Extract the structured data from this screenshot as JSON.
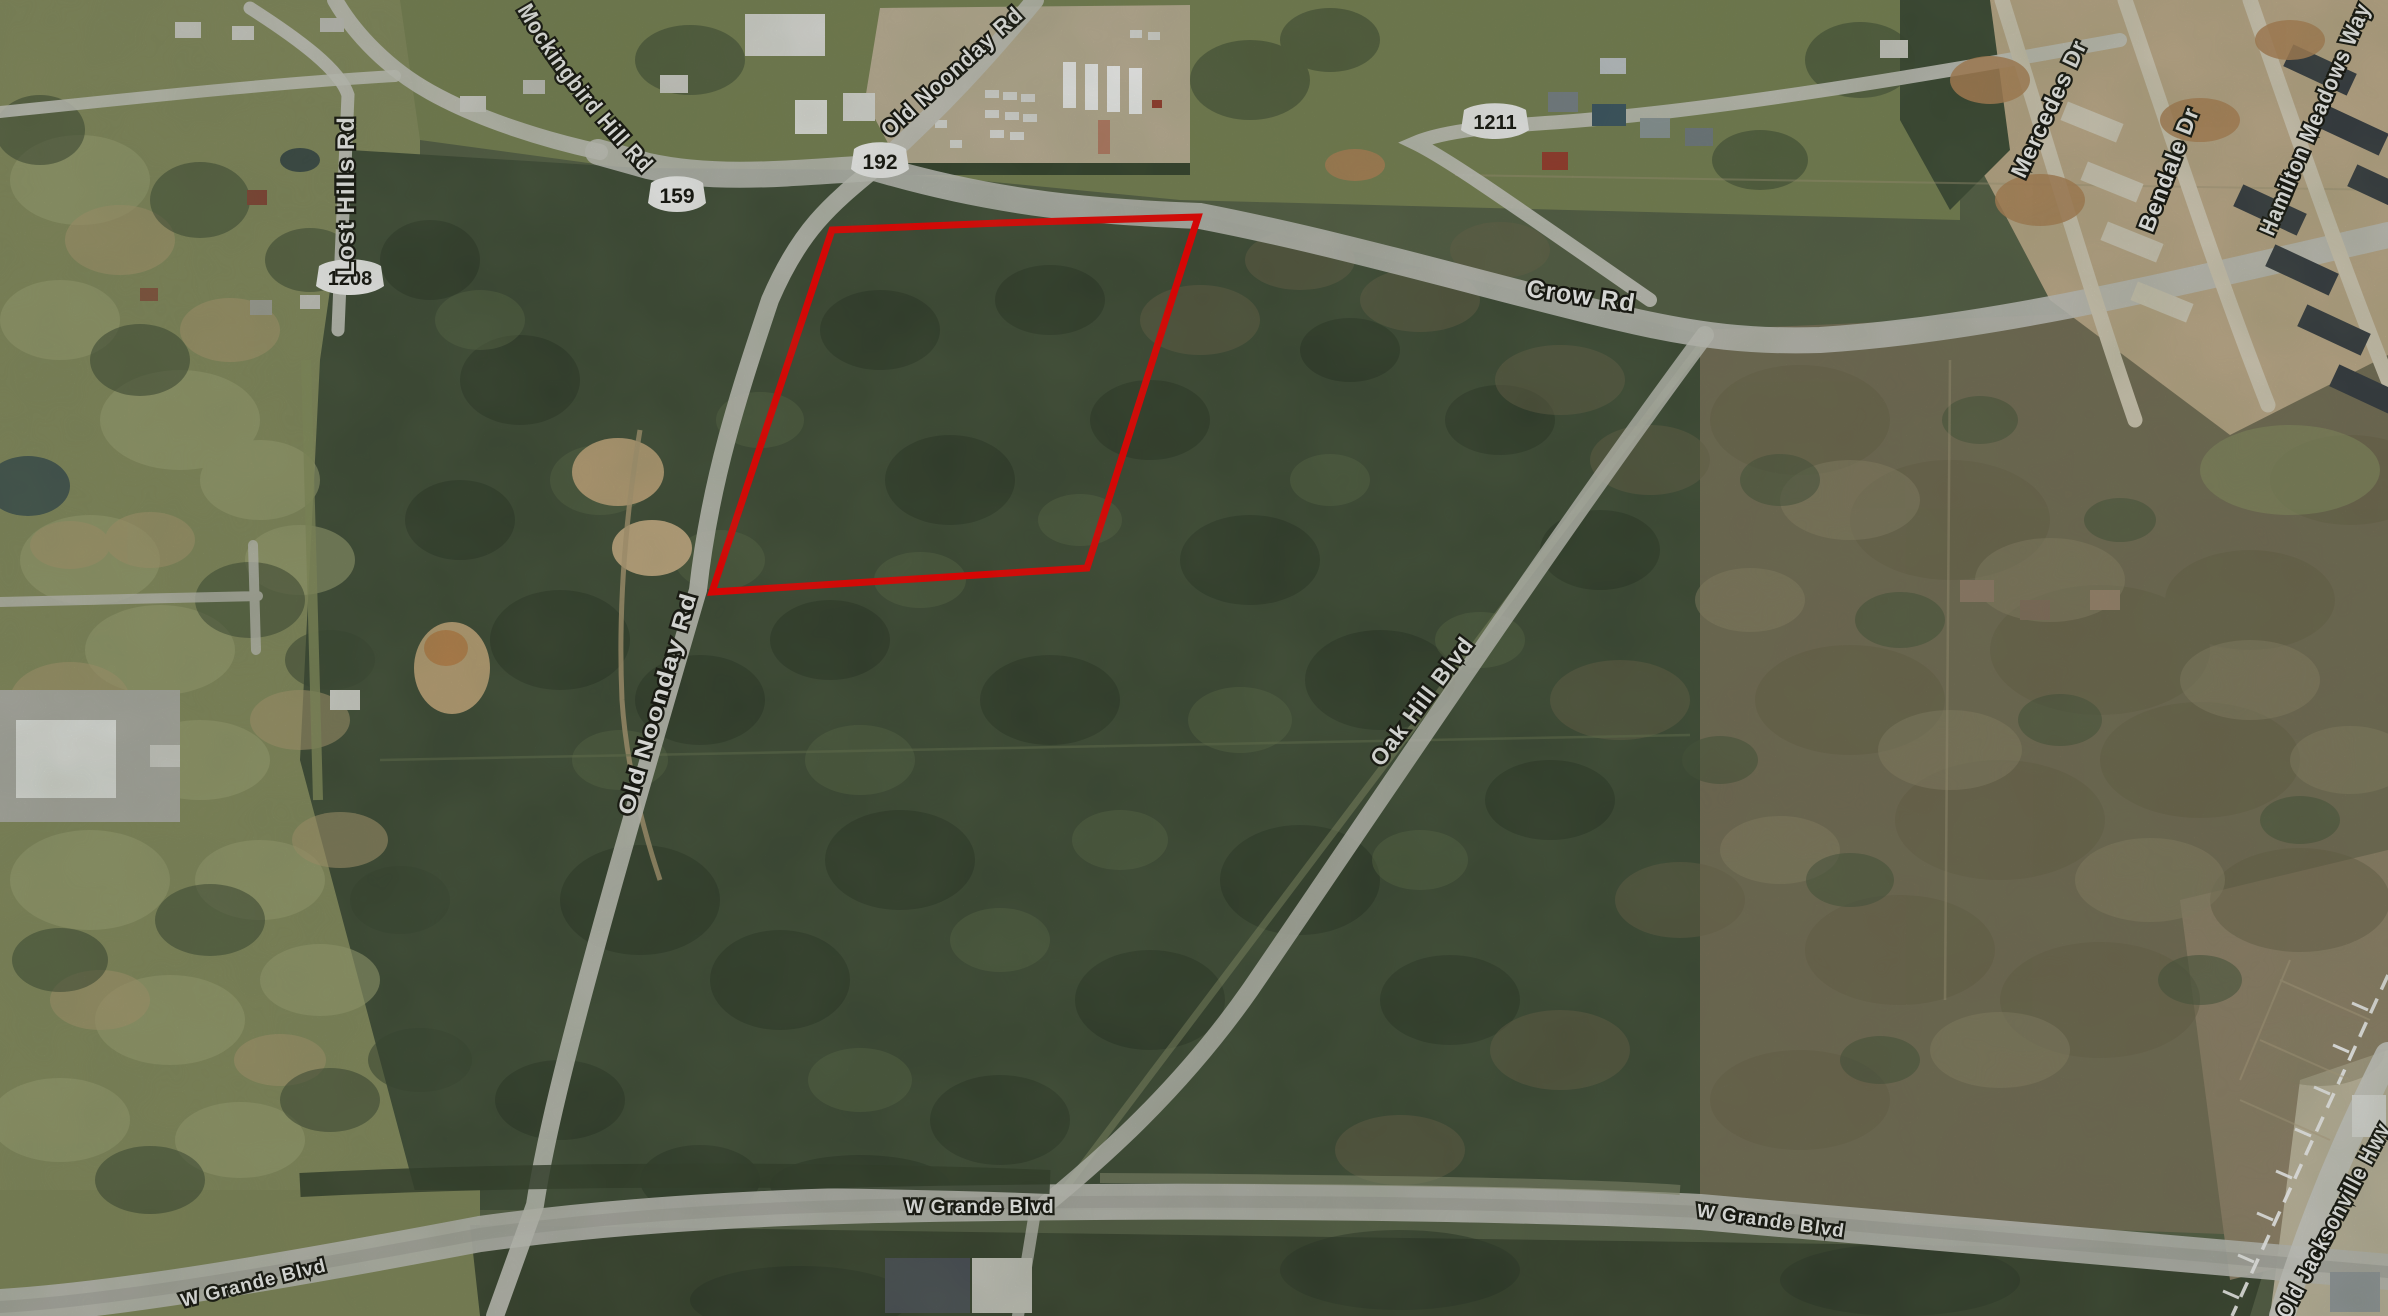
{
  "map": {
    "description": "Aerial satellite parcel map with red property boundary outline",
    "parcel": {
      "outline_color": "#FF0000"
    },
    "labels": {
      "mockingbird": "Mockingbird Hill Rd",
      "old_noonday_top": "Old Noonday Rd",
      "old_noonday_mid": "Old Noonday Rd",
      "crow": "Crow Rd",
      "lost_hills": "Lost Hills Rd",
      "mercedes": "Mercedes Dr",
      "bendale": "Bendale Dr",
      "hamilton": "Hamilton Meadows Way",
      "oak_hill": "Oak Hill Blvd",
      "w_grande_left": "W Grande Blvd",
      "w_grande_center": "W Grande Blvd",
      "w_grande_right": "W Grande Blvd",
      "old_jacksonville": "Old Jacksonville Hwy"
    },
    "shields": {
      "s159": "159",
      "s192": "192",
      "s1208": "1208",
      "s1211": "1211"
    }
  }
}
